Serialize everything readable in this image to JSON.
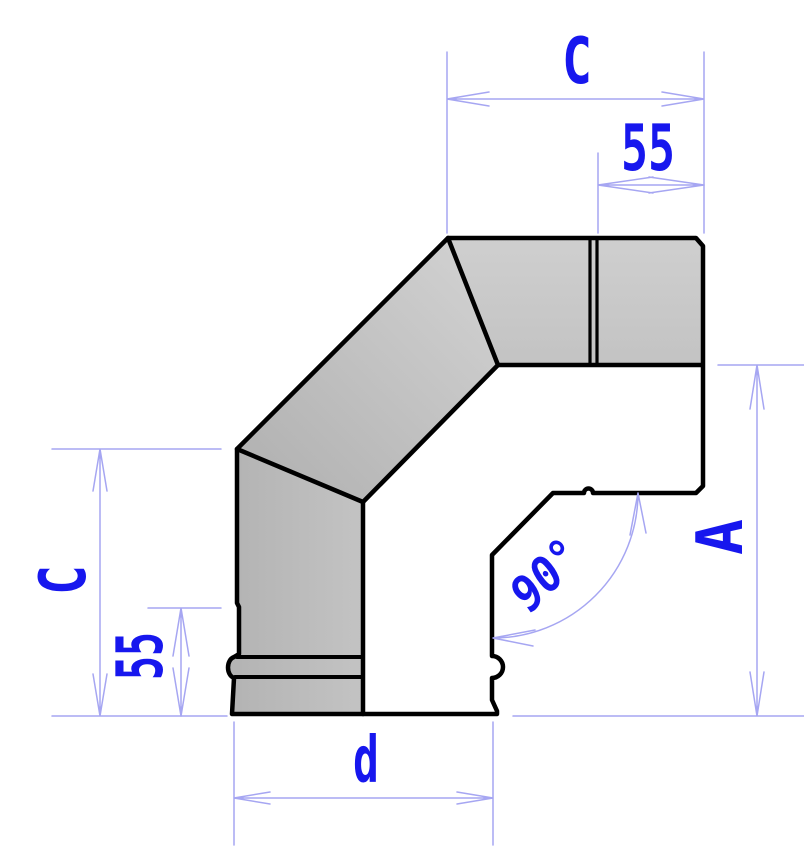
{
  "drawing": {
    "type": "technical-dimension-drawing",
    "subject": "90-degree segmented pipe elbow (flue/chimney bend), side view"
  },
  "dimensions": {
    "top_length_label": "C",
    "top_socket_label": "55",
    "left_length_label": "C",
    "left_socket_label": "55",
    "side_height_label": "A",
    "angle_label": "90°",
    "diameter_label": "d"
  },
  "colors": {
    "outline": "#000000",
    "dim_line": "#a6a6f2",
    "dim_text": "#1717ee",
    "body_dark": "#b4b4b4",
    "body_mid": "#c3c3c3",
    "body_light": "#cfcfcf",
    "background": "#ffffff"
  }
}
